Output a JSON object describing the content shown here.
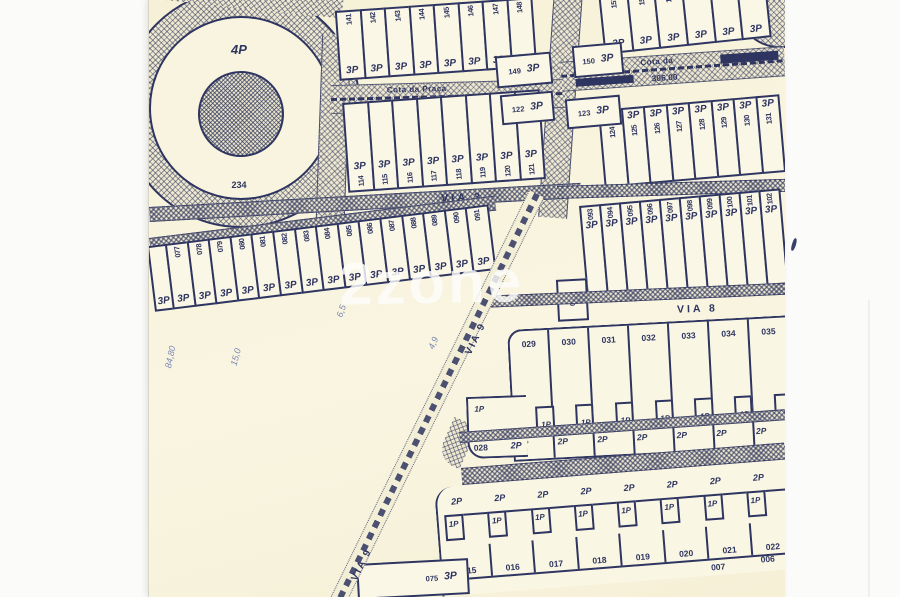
{
  "colors": {
    "ink": "#2e3560",
    "paper": "#f7f2da"
  },
  "watermark": "2zone",
  "roundabout": {
    "zone": "4P",
    "lot": "234"
  },
  "streets": {
    "via3": "VIA 3",
    "via7": "VIA 7",
    "via8": "VIA 8",
    "via9": "VIA 9",
    "cota_left": {
      "name": "Cota da Praça",
      "value": "102.00"
    },
    "cota_right": {
      "name": "Cota da",
      "value": "306.00"
    }
  },
  "rows": {
    "top1_left": {
      "p": "3P",
      "lots": [
        "141",
        "142",
        "143",
        "144",
        "145",
        "146",
        "147",
        "148"
      ]
    },
    "top1_right": {
      "p": "3P",
      "lots": [
        "151",
        "152",
        "153",
        "154",
        "155",
        ""
      ]
    },
    "top2_left": {
      "p": "3P",
      "lots": [
        "114",
        "115",
        "116",
        "117",
        "118",
        "119",
        "120",
        "121"
      ]
    },
    "top2_right": {
      "p": "3P",
      "lots": [
        "124",
        "125",
        "126",
        "127",
        "128",
        "129",
        "130",
        "131"
      ]
    },
    "mid_left": {
      "p": "3P",
      "lots": [
        "077",
        "078",
        "079",
        "080",
        "081",
        "082",
        "083",
        "084",
        "085",
        "086",
        "087",
        "088",
        "089",
        "090",
        "091"
      ]
    },
    "mid_right": {
      "p": "3P",
      "lots": [
        "093",
        "094",
        "095",
        "096",
        "097",
        "098",
        "099",
        "100",
        "101",
        "102"
      ]
    },
    "block_mid": {
      "upper": "1P",
      "lower": "2P",
      "lots": [
        "029",
        "030",
        "031",
        "032",
        "033",
        "034",
        "035"
      ]
    },
    "block_bottom": {
      "upper": "2P",
      "lower": "1P",
      "lots": [
        "015",
        "016",
        "017",
        "018",
        "019",
        "020",
        "021",
        "022"
      ],
      "below": [
        "007",
        "006"
      ]
    }
  },
  "single_lots": {
    "lot149": {
      "id": "149",
      "p": "3P"
    },
    "lot150": {
      "id": "150",
      "p": "3P"
    },
    "lot122": {
      "id": "122",
      "p": "3P"
    },
    "lot123": {
      "id": "123",
      "p": "3P"
    },
    "lot092": {
      "id": "092"
    },
    "lot075": {
      "id": "075",
      "p": "3P"
    },
    "lot028": {
      "id": "028",
      "upper": "1P",
      "lower": "2P"
    }
  },
  "annotations": [
    "84,80",
    "15,0",
    "6,5",
    "4,9"
  ]
}
